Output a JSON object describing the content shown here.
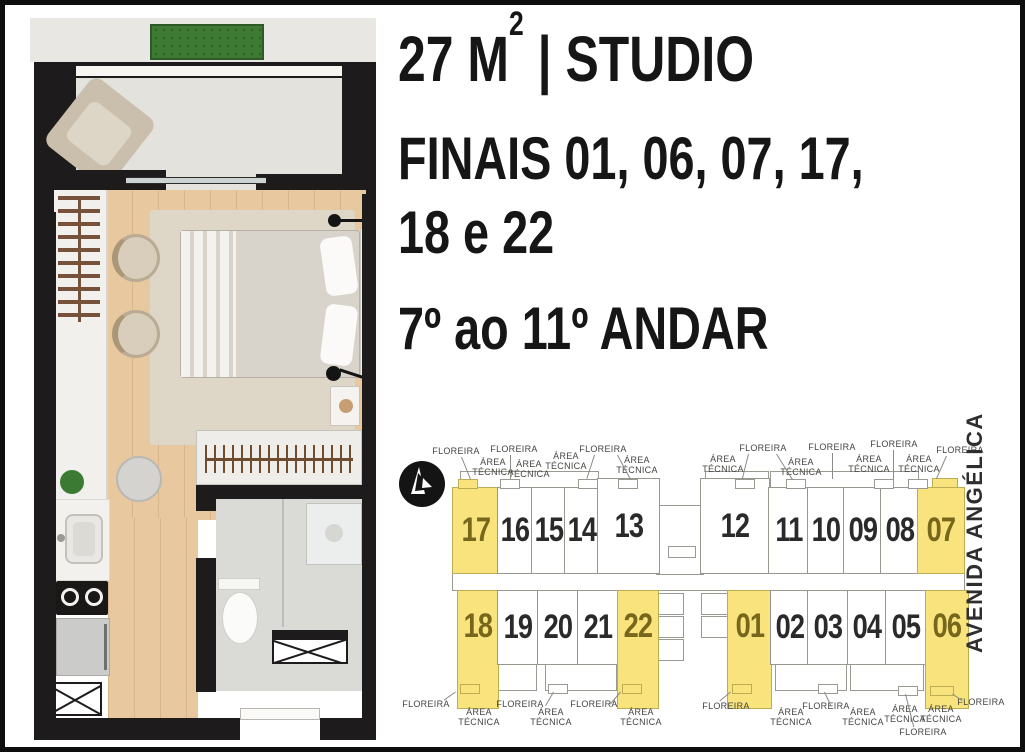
{
  "header": {
    "area_prefix": "27 M",
    "area_sup": "2",
    "area_suffix": " | STUDIO",
    "finais_line1": "FINAIS 01, 06, 07, 17,",
    "finais_line2": "18 e 22",
    "floors": "7º ao 11º ANDAR"
  },
  "keyplan": {
    "street": "AVENIDA ANGÉLICA",
    "labels": {
      "floreira": "FLOREIRA",
      "area_tecnica": "ÁREA TÉCNICA"
    },
    "highlighted_units": [
      "01",
      "06",
      "07",
      "17",
      "18",
      "22"
    ],
    "rows": {
      "top_left": [
        "17",
        "16",
        "15",
        "14",
        "13"
      ],
      "top_right": [
        "12",
        "11",
        "10",
        "09",
        "08",
        "07"
      ],
      "bottom_left": [
        "18",
        "19",
        "20",
        "21",
        "22"
      ],
      "bottom_right": [
        "01",
        "02",
        "03",
        "04",
        "05",
        "06"
      ]
    }
  },
  "colors": {
    "highlight_yellow": "#f8e37c",
    "highlight_number": "#77671c",
    "wall_dark": "#1d1b1b",
    "wood_floor": "#e8c89f",
    "planter_green": "#3f7a34",
    "keyplan_line": "#9a9a92"
  }
}
